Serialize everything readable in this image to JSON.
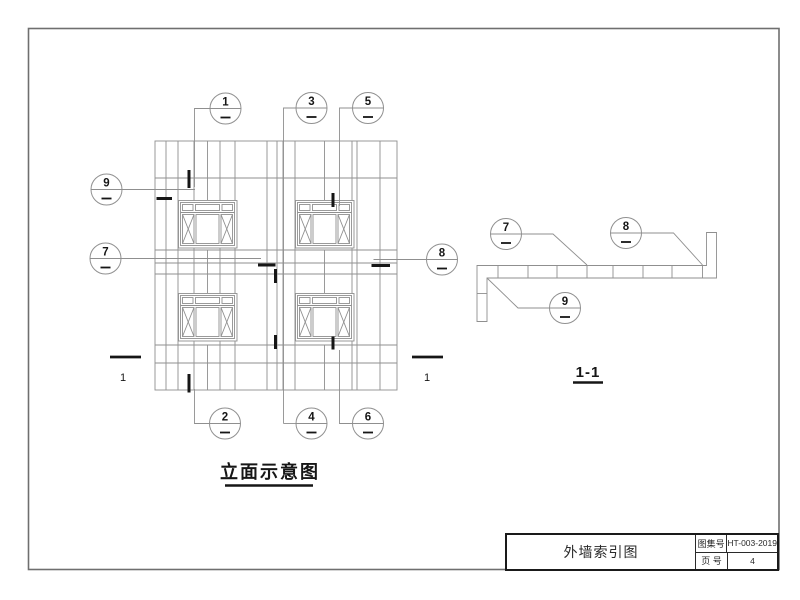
{
  "sheet": {
    "background": "#ffffff",
    "border_color": "#6f6f6f",
    "line_color": "#8f8f8f",
    "ink_color": "#161616"
  },
  "elevation": {
    "title": "立面示意图",
    "section_mark_left_label": "1",
    "section_mark_right_label": "1",
    "callouts": [
      {
        "num": "1",
        "cx": 225.5,
        "cy": 108.5,
        "leader": "210,108.5 194.5,108.5 194.5,187",
        "tick": [
          189,
          170,
          189,
          188
        ]
      },
      {
        "num": "3",
        "cx": 311.5,
        "cy": 108,
        "leader": "296,108 283.5,108 283.5,423.5",
        "tick": [
          275.5,
          269,
          275.5,
          283
        ]
      },
      {
        "num": "5",
        "cx": 368,
        "cy": 108,
        "leader": "352.5,108 339.5,108 339.5,206",
        "tick": [
          333,
          193,
          333,
          207
        ]
      },
      {
        "num": "9",
        "cx": 106.5,
        "cy": 189.5,
        "leader": "122,189.5 195,189.5",
        "tick": [
          156.5,
          198.5,
          172,
          198.5
        ]
      },
      {
        "num": "7",
        "cx": 105.5,
        "cy": 258.5,
        "leader": "121,258.5 261,258.5",
        "tick": [
          258,
          265,
          275.5,
          265
        ]
      },
      {
        "num": "8",
        "cx": 442,
        "cy": 259.5,
        "leader": "426.5,259.5 373.5,259.5",
        "tick": [
          371.5,
          265.5,
          390,
          265.5
        ]
      },
      {
        "num": "2",
        "cx": 225,
        "cy": 423.5,
        "leader": "209.5,423.5 194.5,423.5 194.5,389",
        "tick": [
          189,
          374,
          189,
          392.5
        ]
      },
      {
        "num": "4",
        "cx": 311.5,
        "cy": 423.5,
        "leader": "296,423.5 283.5,423.5",
        "tick": [
          275.5,
          335,
          275.5,
          349
        ]
      },
      {
        "num": "6",
        "cx": 368,
        "cy": 423.5,
        "leader": "352.5,423.5 339.5,423.5 339.5,350",
        "tick": [
          333,
          336.5,
          333,
          349.5
        ]
      }
    ]
  },
  "section": {
    "title": "1-1",
    "callouts": [
      {
        "num": "7",
        "cx": 506,
        "cy": 234,
        "leader": "521.5,234 553,234 587,265",
        "tick": null
      },
      {
        "num": "8",
        "cx": 626,
        "cy": 233,
        "leader": "641.5,233 673.5,233 702.5,265",
        "tick": null
      },
      {
        "num": "9",
        "cx": 565,
        "cy": 308,
        "leader": "549.5,308 518,308 487.5,278.5",
        "tick": null
      }
    ]
  },
  "title_block": {
    "drawing_title": "外墙索引图",
    "atlas_label": "图集号",
    "atlas_value": "HT-003-2019",
    "page_label": "页 号",
    "page_value": "4"
  }
}
